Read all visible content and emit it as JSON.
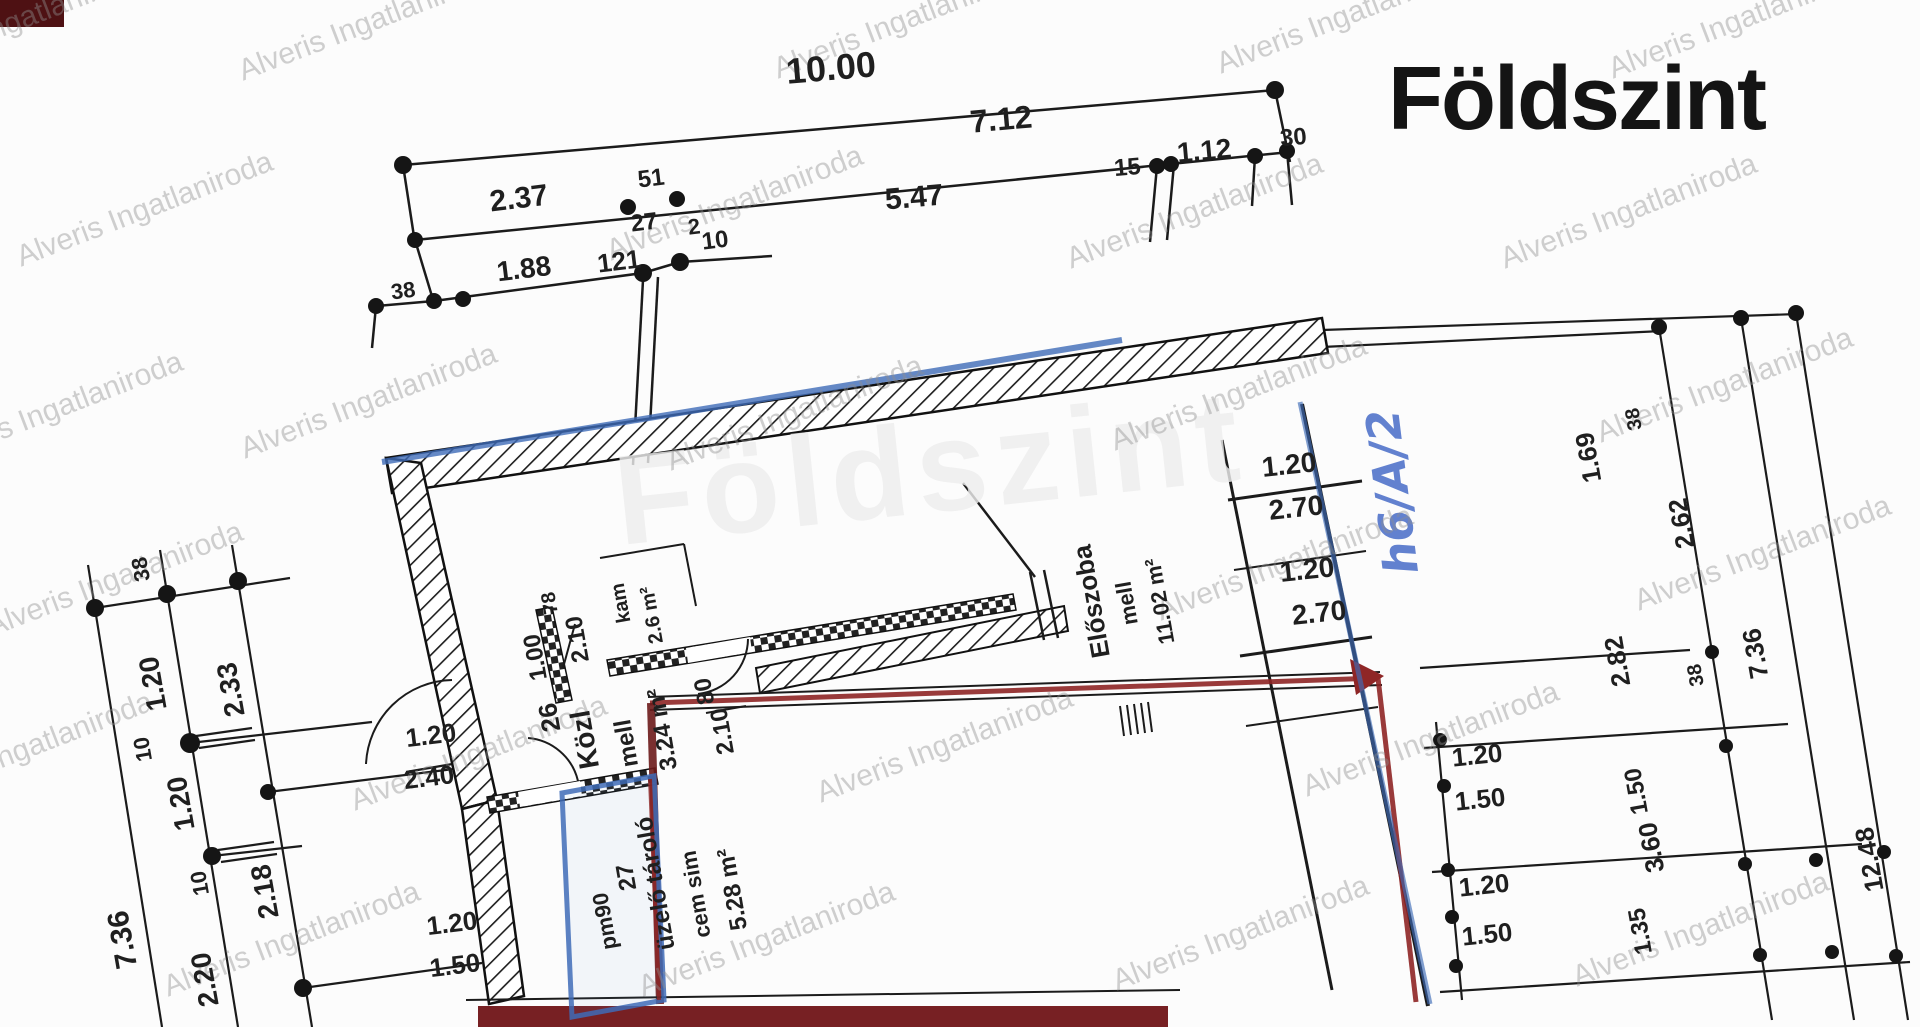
{
  "title": "Földszint",
  "ghost_text": "Földszint",
  "watermark": {
    "text": "Alveris Ingatlaniroda",
    "color": "#8f8f8f",
    "rotation": -21,
    "instances": [
      {
        "x": 20,
        "y": 30
      },
      {
        "x": 370,
        "y": 32
      },
      {
        "x": 905,
        "y": 30
      },
      {
        "x": 1348,
        "y": 25
      },
      {
        "x": 1740,
        "y": 30
      },
      {
        "x": 148,
        "y": 218
      },
      {
        "x": 738,
        "y": 212
      },
      {
        "x": 1198,
        "y": 220
      },
      {
        "x": 1632,
        "y": 220
      },
      {
        "x": 58,
        "y": 418
      },
      {
        "x": 372,
        "y": 410
      },
      {
        "x": 798,
        "y": 422
      },
      {
        "x": 1242,
        "y": 402
      },
      {
        "x": 1728,
        "y": 394
      },
      {
        "x": 118,
        "y": 588
      },
      {
        "x": 1288,
        "y": 572
      },
      {
        "x": 1766,
        "y": 562
      },
      {
        "x": 28,
        "y": 758
      },
      {
        "x": 482,
        "y": 762
      },
      {
        "x": 948,
        "y": 754
      },
      {
        "x": 1434,
        "y": 748
      },
      {
        "x": 295,
        "y": 948
      },
      {
        "x": 770,
        "y": 948
      },
      {
        "x": 1244,
        "y": 942
      },
      {
        "x": 1704,
        "y": 938
      }
    ]
  },
  "handwritten_note": {
    "text": "h6/A/2",
    "color": "#3c63c4"
  },
  "colors": {
    "paper": "#fcfcfc",
    "ink": "#1b1b1b",
    "blue_highlight": "#3f6cb8",
    "red_highlight": "#8f2626",
    "dark_red_bar": "#772023",
    "corner_block": "#4e1113"
  },
  "rooms": [
    {
      "name": "közlekedő",
      "label": "Közl mell",
      "area": "3.24 m²"
    },
    {
      "name": "tároló",
      "label": "üzelő tároló cem sim",
      "area": "5.28 m²"
    },
    {
      "name": "előszoba",
      "label": "Előszoba mell",
      "area": "11.02 m²"
    },
    {
      "name": "kamra",
      "label": "kam",
      "area": "2.6 m²"
    }
  ],
  "labels": [
    {
      "name": "dim-top",
      "t": "10.00",
      "x": 832,
      "y": 80,
      "r": -5,
      "s": 36
    },
    {
      "name": "dim-top",
      "t": "7.12",
      "x": 1002,
      "y": 130,
      "r": -5,
      "s": 32
    },
    {
      "name": "dim-top",
      "t": "2.37",
      "x": 520,
      "y": 208,
      "r": -7,
      "s": 30
    },
    {
      "name": "dim-top",
      "t": "51",
      "x": 652,
      "y": 186,
      "r": -7,
      "s": 24
    },
    {
      "name": "dim-top",
      "t": "27",
      "x": 645,
      "y": 230,
      "r": -7,
      "s": 24
    },
    {
      "name": "dim-top",
      "t": "5.47",
      "x": 915,
      "y": 207,
      "r": -5,
      "s": 30
    },
    {
      "name": "dim-top",
      "t": "15",
      "x": 1128,
      "y": 175,
      "r": -5,
      "s": 24
    },
    {
      "name": "dim-top",
      "t": "1.12",
      "x": 1205,
      "y": 160,
      "r": -5,
      "s": 28
    },
    {
      "name": "dim-top",
      "t": "30",
      "x": 1294,
      "y": 145,
      "r": -5,
      "s": 24
    },
    {
      "name": "dim-top",
      "t": "38",
      "x": 404,
      "y": 298,
      "r": -7,
      "s": 22
    },
    {
      "name": "dim-top",
      "t": "1.88",
      "x": 525,
      "y": 278,
      "r": -7,
      "s": 28
    },
    {
      "name": "dim-top",
      "t": "121",
      "x": 620,
      "y": 270,
      "r": -7,
      "s": 26
    },
    {
      "name": "dim-top",
      "t": "2",
      "x": 695,
      "y": 234,
      "r": -7,
      "s": 22
    },
    {
      "name": "dim-top",
      "t": "10",
      "x": 716,
      "y": 248,
      "r": -7,
      "s": 24
    },
    {
      "name": "dim-left",
      "t": "38",
      "x": 148,
      "y": 568,
      "r": -100,
      "s": 22
    },
    {
      "name": "dim-left",
      "t": "1.20",
      "x": 162,
      "y": 682,
      "r": -100,
      "s": 28
    },
    {
      "name": "dim-left",
      "t": "2.33",
      "x": 240,
      "y": 688,
      "r": -100,
      "s": 28
    },
    {
      "name": "dim-left",
      "t": "10",
      "x": 150,
      "y": 748,
      "r": -100,
      "s": 22
    },
    {
      "name": "dim-left",
      "t": "1.20",
      "x": 190,
      "y": 802,
      "r": -100,
      "s": 28
    },
    {
      "name": "dim-left",
      "t": "10",
      "x": 207,
      "y": 882,
      "r": -100,
      "s": 22
    },
    {
      "name": "dim-left",
      "t": "2.18",
      "x": 274,
      "y": 890,
      "r": -100,
      "s": 28
    },
    {
      "name": "dim-left",
      "t": "7.36",
      "x": 132,
      "y": 938,
      "r": -100,
      "s": 30
    },
    {
      "name": "dim-left",
      "t": "2.20",
      "x": 214,
      "y": 978,
      "r": -100,
      "s": 28
    },
    {
      "name": "dim-left",
      "t": "1.20",
      "x": 453,
      "y": 932,
      "r": -7,
      "s": 26
    },
    {
      "name": "dim-left",
      "t": "1.50",
      "x": 456,
      "y": 974,
      "r": -7,
      "s": 26
    },
    {
      "name": "door-spec",
      "t": "1.20",
      "x": 432,
      "y": 744,
      "r": -7,
      "s": 26
    },
    {
      "name": "door-spec",
      "t": "2.40",
      "x": 430,
      "y": 786,
      "r": -7,
      "s": 26
    },
    {
      "name": "door-spec",
      "t": "78",
      "x": 556,
      "y": 602,
      "r": -100,
      "s": 20
    },
    {
      "name": "door-spec",
      "t": "1.00",
      "x": 543,
      "y": 656,
      "r": -100,
      "s": 24
    },
    {
      "name": "door-spec",
      "t": "2.10",
      "x": 585,
      "y": 638,
      "r": -100,
      "s": 24
    },
    {
      "name": "wall-dim",
      "t": "26",
      "x": 558,
      "y": 716,
      "r": -100,
      "s": 26
    },
    {
      "name": "room-label",
      "t": "Közl",
      "x": 594,
      "y": 738,
      "r": -100,
      "s": 28
    },
    {
      "name": "room-label",
      "t": "mell",
      "x": 634,
      "y": 742,
      "r": -100,
      "s": 24
    },
    {
      "name": "room-area",
      "t": "3.24 m²",
      "x": 670,
      "y": 728,
      "r": -100,
      "s": 24
    },
    {
      "name": "door-spec",
      "t": "80",
      "x": 712,
      "y": 690,
      "r": -100,
      "s": 24
    },
    {
      "name": "door-spec",
      "t": "2.10",
      "x": 730,
      "y": 730,
      "r": -100,
      "s": 24
    },
    {
      "name": "room-label",
      "t": "kam",
      "x": 627,
      "y": 602,
      "r": -100,
      "s": 20
    },
    {
      "name": "room-area",
      "t": "2.6 m²",
      "x": 658,
      "y": 614,
      "r": -100,
      "s": 20
    },
    {
      "name": "wall-dim",
      "t": "27",
      "x": 634,
      "y": 876,
      "r": -100,
      "s": 24
    },
    {
      "name": "room-label",
      "t": "üzelő tároló",
      "x": 663,
      "y": 882,
      "r": -100,
      "s": 24
    },
    {
      "name": "room-label",
      "t": "cem sim",
      "x": 703,
      "y": 893,
      "r": -100,
      "s": 22
    },
    {
      "name": "room-area",
      "t": "5.28 m²",
      "x": 740,
      "y": 888,
      "r": -100,
      "s": 24
    },
    {
      "name": "door-spec",
      "t": "pm90",
      "x": 612,
      "y": 920,
      "r": -100,
      "s": 22
    },
    {
      "name": "room-label",
      "t": "Előszoba",
      "x": 1100,
      "y": 600,
      "r": -100,
      "s": 26
    },
    {
      "name": "room-label",
      "t": "mell",
      "x": 1134,
      "y": 602,
      "r": -100,
      "s": 22
    },
    {
      "name": "room-area",
      "t": "11.02 m²",
      "x": 1167,
      "y": 600,
      "r": -100,
      "s": 22
    },
    {
      "name": "dim-right",
      "t": "1.20",
      "x": 1290,
      "y": 474,
      "r": -6,
      "s": 28
    },
    {
      "name": "dim-right",
      "t": "2.70",
      "x": 1297,
      "y": 517,
      "r": -6,
      "s": 28
    },
    {
      "name": "dim-right",
      "t": "1.20",
      "x": 1308,
      "y": 579,
      "r": -6,
      "s": 28
    },
    {
      "name": "dim-right",
      "t": "2.70",
      "x": 1320,
      "y": 622,
      "r": -6,
      "s": 28
    },
    {
      "name": "dim-right",
      "t": "1.69",
      "x": 1597,
      "y": 456,
      "r": -100,
      "s": 26
    },
    {
      "name": "dim-right",
      "t": "38",
      "x": 1640,
      "y": 418,
      "r": -100,
      "s": 20
    },
    {
      "name": "dim-right",
      "t": "2.62",
      "x": 1690,
      "y": 522,
      "r": -100,
      "s": 26
    },
    {
      "name": "dim-right",
      "t": "2.82",
      "x": 1626,
      "y": 660,
      "r": -100,
      "s": 26
    },
    {
      "name": "dim-right",
      "t": "38",
      "x": 1702,
      "y": 674,
      "r": -100,
      "s": 20
    },
    {
      "name": "dim-right",
      "t": "7.36",
      "x": 1764,
      "y": 652,
      "r": -100,
      "s": 26
    },
    {
      "name": "dim-right",
      "t": "12.48",
      "x": 1878,
      "y": 858,
      "r": -100,
      "s": 26
    },
    {
      "name": "dim-right",
      "t": "1.50",
      "x": 1644,
      "y": 790,
      "r": -100,
      "s": 24
    },
    {
      "name": "dim-right",
      "t": "3.60",
      "x": 1660,
      "y": 846,
      "r": -100,
      "s": 26
    },
    {
      "name": "dim-right",
      "t": "1.35",
      "x": 1648,
      "y": 930,
      "r": -100,
      "s": 24
    },
    {
      "name": "dim-right",
      "t": "1.20",
      "x": 1478,
      "y": 764,
      "r": -6,
      "s": 26
    },
    {
      "name": "dim-right",
      "t": "1.50",
      "x": 1481,
      "y": 808,
      "r": -6,
      "s": 26
    },
    {
      "name": "dim-right",
      "t": "1.20",
      "x": 1485,
      "y": 894,
      "r": -6,
      "s": 26
    },
    {
      "name": "dim-right",
      "t": "1.50",
      "x": 1488,
      "y": 943,
      "r": -6,
      "s": 26
    }
  ]
}
